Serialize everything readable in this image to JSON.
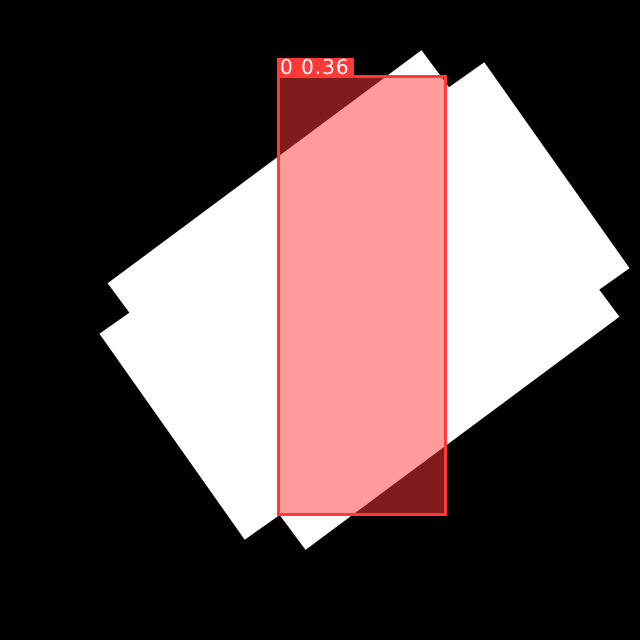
{
  "canvas": {
    "background_color": "#000000",
    "object_color": "#ffffff"
  },
  "detection": {
    "label": "0 0.36",
    "class_id": "0",
    "confidence": "0.36",
    "box_color": "#ff3838",
    "box_fill_color": "rgba(255,56,56,0.5)",
    "label_background_color": "#ff3838",
    "label_text_color": "#ffffff"
  }
}
